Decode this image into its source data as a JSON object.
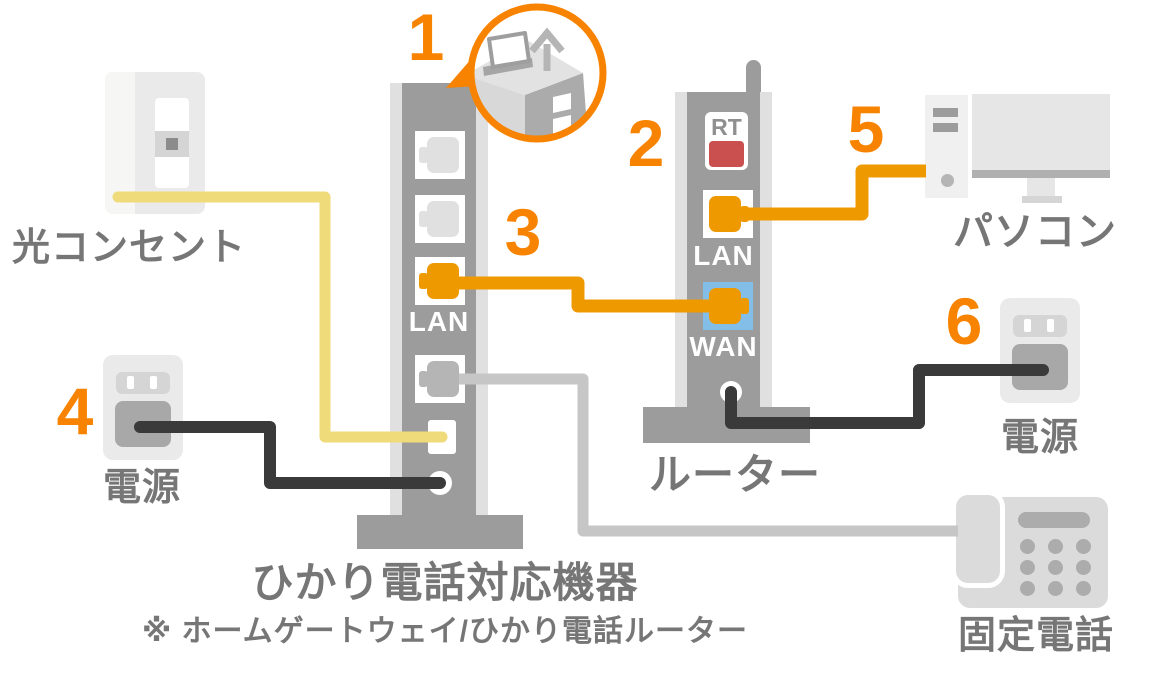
{
  "steps": [
    "1",
    "2",
    "3",
    "4",
    "5",
    "6"
  ],
  "labels": {
    "optical_outlet": "光コンセント",
    "power_left": "電源",
    "power_right": "電源",
    "router": "ルーター",
    "pc": "パソコン",
    "phone": "固定電話",
    "device_title": "ひかり電話対応機器",
    "device_note": "※ ホームゲートウェイ/ひかり電話ルーター"
  },
  "device": {
    "lan_label": "LAN"
  },
  "router": {
    "rt_label": "RT",
    "lan_label": "LAN",
    "wan_label": "WAN"
  },
  "icons": {
    "optical_outlet": "wall-outlet-icon",
    "power_left": "power-plug-icon",
    "power_right": "power-plug-icon",
    "pc": "desktop-computer-icon",
    "phone": "landline-phone-icon",
    "callout": "insert-card-up-arrow-icon"
  },
  "colors": {
    "accent_orange": "#F88300",
    "cable_orange": "#EE9900",
    "cable_yellow": "#EFDB7A",
    "cable_black": "#3A3A3A",
    "cable_gray": "#C6C6C6",
    "device_gray": "#9C9C9C",
    "device_highlight": "#E0E0E0",
    "port_white": "#FFFFFF",
    "wan_blue": "#82BEE8",
    "rt_red": "#C9504E",
    "rt_text": "#8F8F8F",
    "label_gray": "#767676",
    "icon_light": "#EAEAEA",
    "icon_lighter": "#F6F6F4",
    "icon_mid": "#D5D5D5",
    "icon_dark": "#A8A8A8",
    "icon_dot": "#8C8C8C",
    "plug_empty": "#E0E0E0",
    "plug_gray": "#B5B5B5",
    "pc_tower": "#F0F0F0",
    "monitor": "#E6E6E6",
    "monitor_bar": "#B0B0B0",
    "phone_gray": "#DBDBDB",
    "phone_detail": "#ACACAC"
  }
}
